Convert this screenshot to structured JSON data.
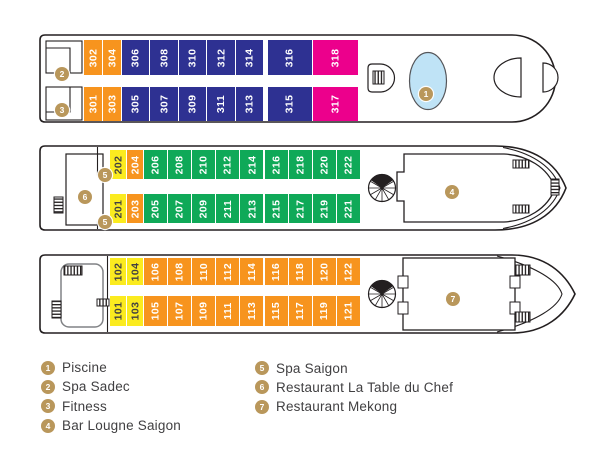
{
  "colors": {
    "orange": "#F7941E",
    "blue": "#2E3192",
    "pink": "#EC008C",
    "yellow": "#FBEB1F",
    "green": "#0FA958",
    "gold": "#B9975B",
    "pool": "#BFE3F6",
    "outline": "#231F20",
    "text": "#414042"
  },
  "decks": [
    {
      "markers": [
        {
          "n": "2"
        },
        {
          "n": "3"
        },
        {
          "n": "1"
        }
      ],
      "rows": {
        "top": [
          {
            "num": "302",
            "color": "orange"
          },
          {
            "num": "304",
            "color": "orange"
          },
          {
            "num": "306",
            "color": "blue"
          },
          {
            "num": "308",
            "color": "blue"
          },
          {
            "num": "310",
            "color": "blue"
          },
          {
            "num": "312",
            "color": "blue"
          },
          {
            "num": "314",
            "color": "blue"
          },
          {
            "num": "316",
            "color": "blue"
          },
          {
            "num": "318",
            "color": "pink"
          }
        ],
        "bottom": [
          {
            "num": "301",
            "color": "orange"
          },
          {
            "num": "303",
            "color": "orange"
          },
          {
            "num": "305",
            "color": "blue"
          },
          {
            "num": "307",
            "color": "blue"
          },
          {
            "num": "309",
            "color": "blue"
          },
          {
            "num": "311",
            "color": "blue"
          },
          {
            "num": "313",
            "color": "blue"
          },
          {
            "num": "315",
            "color": "blue"
          },
          {
            "num": "317",
            "color": "pink"
          }
        ]
      }
    },
    {
      "markers": [
        {
          "n": "5"
        },
        {
          "n": "6"
        },
        {
          "n": "5"
        },
        {
          "n": "4"
        }
      ],
      "rows": {
        "top": [
          {
            "num": "202",
            "color": "yellow"
          },
          {
            "num": "204",
            "color": "orange"
          },
          {
            "num": "206",
            "color": "green"
          },
          {
            "num": "208",
            "color": "green"
          },
          {
            "num": "210",
            "color": "green"
          },
          {
            "num": "212",
            "color": "green"
          },
          {
            "num": "214",
            "color": "green"
          },
          {
            "num": "216",
            "color": "green"
          },
          {
            "num": "218",
            "color": "green"
          },
          {
            "num": "220",
            "color": "green"
          },
          {
            "num": "222",
            "color": "green"
          }
        ],
        "bottom": [
          {
            "num": "201",
            "color": "yellow"
          },
          {
            "num": "203",
            "color": "orange"
          },
          {
            "num": "205",
            "color": "green"
          },
          {
            "num": "207",
            "color": "green"
          },
          {
            "num": "209",
            "color": "green"
          },
          {
            "num": "211",
            "color": "green"
          },
          {
            "num": "213",
            "color": "green"
          },
          {
            "num": "215",
            "color": "green"
          },
          {
            "num": "217",
            "color": "green"
          },
          {
            "num": "219",
            "color": "green"
          },
          {
            "num": "221",
            "color": "green"
          }
        ]
      }
    },
    {
      "markers": [
        {
          "n": "7"
        }
      ],
      "rows": {
        "top": [
          {
            "num": "102",
            "color": "yellow"
          },
          {
            "num": "104",
            "color": "yellow"
          },
          {
            "num": "106",
            "color": "orange"
          },
          {
            "num": "108",
            "color": "orange"
          },
          {
            "num": "110",
            "color": "orange"
          },
          {
            "num": "112",
            "color": "orange"
          },
          {
            "num": "114",
            "color": "orange"
          },
          {
            "num": "116",
            "color": "orange"
          },
          {
            "num": "118",
            "color": "orange"
          },
          {
            "num": "120",
            "color": "orange"
          },
          {
            "num": "122",
            "color": "orange"
          }
        ],
        "bottom": [
          {
            "num": "101",
            "color": "yellow"
          },
          {
            "num": "103",
            "color": "yellow"
          },
          {
            "num": "105",
            "color": "orange"
          },
          {
            "num": "107",
            "color": "orange"
          },
          {
            "num": "109",
            "color": "orange"
          },
          {
            "num": "111",
            "color": "orange"
          },
          {
            "num": "113",
            "color": "orange"
          },
          {
            "num": "115",
            "color": "orange"
          },
          {
            "num": "117",
            "color": "orange"
          },
          {
            "num": "119",
            "color": "orange"
          },
          {
            "num": "121",
            "color": "orange"
          }
        ]
      }
    }
  ],
  "legend": {
    "columns": [
      [
        {
          "n": "1",
          "label": "Piscine"
        },
        {
          "n": "2",
          "label": "Spa Sadec"
        },
        {
          "n": "3",
          "label": "Fitness"
        },
        {
          "n": "4",
          "label": "Bar Lougne Saigon"
        }
      ],
      [
        {
          "n": "5",
          "label": "Spa Saigon"
        },
        {
          "n": "6",
          "label": "Restaurant La Table du Chef"
        },
        {
          "n": "7",
          "label": "Restaurant Mekong"
        }
      ]
    ]
  }
}
